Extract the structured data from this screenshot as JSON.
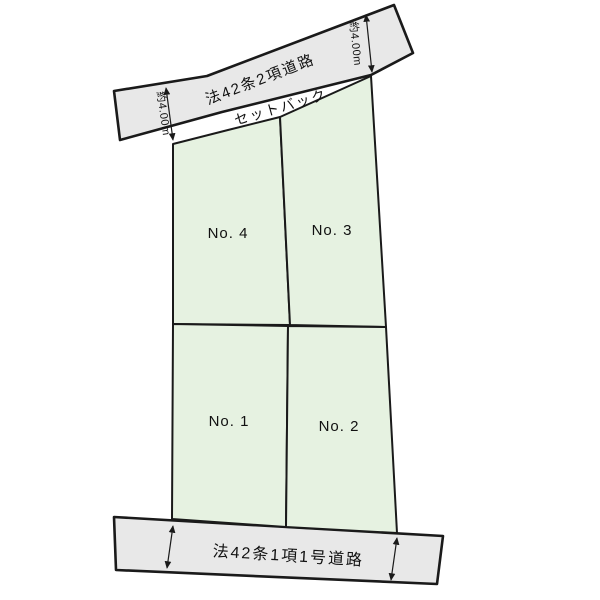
{
  "diagram": {
    "type": "land-plot-layout",
    "roads": {
      "top": {
        "label": "法42条2項道路"
      },
      "bottom": {
        "label": "法42条1項1号道路"
      }
    },
    "setback": {
      "label": "セットバック"
    },
    "dimensions": {
      "left": "約4.00m",
      "right": "約4.00m"
    },
    "lots": [
      {
        "id": "no1",
        "label": "No. 1"
      },
      {
        "id": "no2",
        "label": "No. 2"
      },
      {
        "id": "no3",
        "label": "No. 3"
      },
      {
        "id": "no4",
        "label": "No. 4"
      }
    ],
    "colors": {
      "lot_fill": "#e6f2e1",
      "road_fill": "#e8e8e8",
      "line": "#1a1a1a",
      "background": "#ffffff"
    }
  }
}
